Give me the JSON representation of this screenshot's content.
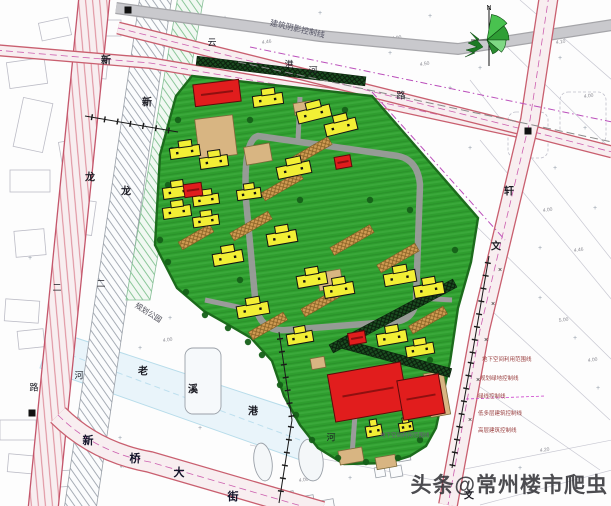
{
  "meta": {
    "watermark": "头条@常州楼市爬虫",
    "plan_type": "residential-site-plan"
  },
  "palette": {
    "site_green": "#2f9e2f",
    "site_green_stripe": "#3aa83a",
    "site_edge": "#1c6b1c",
    "building_yellow": "#f2ef35",
    "building_red": "#e11d1d",
    "paving_tan": "#d8b582",
    "road_pink_fill": "#f8eef0",
    "road_pink_edge": "#c95f6f",
    "road_gray": "#c9c9cd",
    "river_blue": "#e9f4fa",
    "magenta_line": "#bb4fbb",
    "ink": "#1c1c24"
  },
  "map": {
    "site_polygon": "192,76 372,96 478,218 471,262 458,308 450,362 436,428 426,446 410,456 388,463 344,464 318,448 300,425 284,396 272,361 251,338 227,324 204,311 177,288 155,245 160,155 176,96",
    "inner_ring_road": "M258,136 L398,156 Q418,160 420,185 L416,300 Q414,322 390,322 L286,330 Q262,332 256,308 L246,200 Q243,140 258,136 Z",
    "inner_spurs": [
      "M300,97 L298,140",
      "M452,300 L418,298",
      "M352,455 L356,402",
      "M205,300 L252,310"
    ],
    "roads": {
      "left_quad": "79,-4 110,-4 58,510 28,510",
      "left_edges": [
        [
          "79,-4",
          "28,510"
        ],
        [
          "110,-4",
          "58,510"
        ]
      ],
      "bottom_path": "M58,415 Q95,452 150,462 L322,512",
      "east_path": "M549,-5 L530,120 L505,225 L480,330 L448,505",
      "top1_path": "M118,28 L530,131 L612,152",
      "top2_path": "M-5,50 L150,63 L375,101 L528,134",
      "gray_path": "M116,8 L320,36 L458,49 L612,25"
    },
    "river": {
      "poly": "52,330 320,418 306,462 40,368",
      "center": "M70,355 L300,440"
    },
    "hatch_band_gray": "140,-4 172,-4 96,510 64,510",
    "hatch_band_green": "178,-4 204,-4 150,300 126,300",
    "dark_strips": [
      [
        281,
        71,
        170,
        7
      ],
      [
        393,
        316,
        140,
        -28
      ],
      [
        395,
        358,
        115,
        15
      ]
    ],
    "brown_strips": [
      [
        310,
        152,
        46,
        -30
      ],
      [
        282,
        186,
        44,
        -30
      ],
      [
        251,
        226,
        44,
        -30
      ],
      [
        352,
        240,
        46,
        -30
      ],
      [
        398,
        258,
        44,
        -30
      ],
      [
        322,
        302,
        44,
        -30
      ],
      [
        428,
        320,
        40,
        -30
      ],
      [
        268,
        326,
        40,
        -30
      ],
      [
        196,
        237,
        36,
        -30
      ]
    ],
    "tan_patches": [
      [
        216,
        137,
        38,
        40,
        -7
      ],
      [
        258,
        154,
        26,
        18,
        -10
      ],
      [
        303,
        108,
        18,
        12,
        -10
      ],
      [
        330,
        280,
        24,
        18,
        -10
      ],
      [
        318,
        363,
        14,
        11,
        -10
      ],
      [
        437,
        394,
        20,
        44,
        -10
      ],
      [
        351,
        456,
        24,
        14,
        -10
      ],
      [
        386,
        462,
        20,
        12,
        -10
      ]
    ],
    "yellow_buildings": [
      [
        268,
        100,
        30,
        11,
        -8
      ],
      [
        314,
        114,
        34,
        12,
        -14
      ],
      [
        341,
        127,
        32,
        12,
        -14
      ],
      [
        185,
        152,
        30,
        11,
        -8
      ],
      [
        214,
        162,
        28,
        11,
        -8
      ],
      [
        294,
        170,
        34,
        12,
        -12
      ],
      [
        177,
        192,
        28,
        11,
        -8
      ],
      [
        206,
        200,
        26,
        10,
        -8
      ],
      [
        249,
        194,
        24,
        10,
        -8
      ],
      [
        177,
        212,
        28,
        11,
        -8
      ],
      [
        206,
        221,
        26,
        10,
        -8
      ],
      [
        282,
        238,
        30,
        12,
        -10
      ],
      [
        228,
        258,
        30,
        12,
        -10
      ],
      [
        312,
        280,
        30,
        12,
        -10
      ],
      [
        339,
        290,
        30,
        12,
        -10
      ],
      [
        253,
        310,
        32,
        12,
        -10
      ],
      [
        300,
        338,
        26,
        11,
        -10
      ],
      [
        400,
        278,
        32,
        12,
        -10
      ],
      [
        429,
        290,
        30,
        12,
        -10
      ],
      [
        392,
        338,
        30,
        12,
        -10
      ],
      [
        420,
        350,
        28,
        11,
        -10
      ],
      [
        374,
        431,
        16,
        11,
        -10
      ],
      [
        406,
        427,
        14,
        9,
        -10
      ]
    ],
    "red_buildings": [
      [
        217,
        93,
        46,
        22,
        -7
      ],
      [
        193,
        190,
        18,
        13,
        -8
      ],
      [
        343,
        162,
        16,
        12,
        -10
      ],
      [
        357,
        338,
        17,
        12,
        -10
      ],
      [
        368,
        392,
        74,
        48,
        -10
      ],
      [
        421,
        397,
        42,
        40,
        -10
      ]
    ],
    "trees": [
      [
        178,
        120
      ],
      [
        172,
        150
      ],
      [
        168,
        185
      ],
      [
        170,
        215
      ],
      [
        160,
        240
      ],
      [
        168,
        262
      ],
      [
        186,
        292
      ],
      [
        205,
        315
      ],
      [
        228,
        328
      ],
      [
        248,
        342
      ],
      [
        262,
        355
      ],
      [
        280,
        385
      ],
      [
        296,
        415
      ],
      [
        312,
        440
      ],
      [
        338,
        458
      ],
      [
        366,
        462
      ],
      [
        398,
        458
      ],
      [
        420,
        440
      ],
      [
        250,
        120
      ],
      [
        345,
        110
      ],
      [
        410,
        210
      ],
      [
        455,
        250
      ],
      [
        300,
        200
      ],
      [
        370,
        200
      ],
      [
        240,
        280
      ],
      [
        430,
        360
      ]
    ],
    "parcels_left": [
      [
        8,
        60,
        38,
        26,
        -8
      ],
      [
        18,
        100,
        30,
        50,
        12
      ],
      [
        60,
        140,
        26,
        20,
        -10
      ],
      [
        10,
        170,
        40,
        22,
        0
      ],
      [
        70,
        200,
        24,
        34,
        8
      ],
      [
        15,
        230,
        30,
        26,
        -5
      ],
      [
        85,
        60,
        22,
        18,
        6
      ],
      [
        40,
        20,
        30,
        18,
        -12
      ],
      [
        95,
        20,
        26,
        16,
        0
      ],
      [
        5,
        300,
        34,
        22,
        4
      ],
      [
        18,
        330,
        26,
        18,
        -6
      ],
      [
        0,
        420,
        36,
        20,
        0
      ],
      [
        8,
        455,
        30,
        18,
        5
      ],
      [
        60,
        470,
        26,
        16,
        -4
      ]
    ],
    "right_lines": [
      [
        520,
        0,
        612,
        80
      ],
      [
        500,
        40,
        612,
        150
      ],
      [
        470,
        80,
        612,
        260
      ],
      [
        480,
        140,
        612,
        300
      ],
      [
        470,
        220,
        612,
        360
      ],
      [
        480,
        300,
        610,
        420
      ],
      [
        470,
        380,
        600,
        470
      ],
      [
        460,
        470,
        612,
        440
      ],
      [
        480,
        505,
        612,
        470
      ],
      [
        250,
        445,
        460,
        485
      ]
    ],
    "right_outline_rects": [
      [
        560,
        92,
        46,
        52
      ],
      [
        508,
        112,
        40,
        46
      ]
    ],
    "row_houses": [
      [
        383,
        452,
        12,
        11
      ],
      [
        398,
        450,
        12,
        11
      ],
      [
        390,
        466,
        12,
        11
      ],
      [
        375,
        467,
        10,
        10
      ],
      [
        258,
        488,
        16,
        10
      ],
      [
        278,
        492,
        16,
        10
      ],
      [
        298,
        496,
        16,
        10
      ],
      [
        318,
        500,
        16,
        10
      ]
    ],
    "pond_ellipses": [
      [
        263,
        462,
        9,
        19
      ],
      [
        311,
        460,
        12,
        21
      ]
    ],
    "river_parcel": [
      185,
      348,
      36,
      66
    ],
    "dash_magenta": [
      "M250,47 L612,122",
      "M372,92 L505,240"
    ],
    "dash_gray": [
      "M238,62 L612,142"
    ],
    "tick_lines": [
      [
        [
          85,
          116
        ],
        [
          178,
          132
        ]
      ],
      [
        [
          489,
          256
        ],
        [
          472,
          356
        ],
        [
          452,
          468
        ]
      ],
      [
        [
          279,
          332
        ],
        [
          292,
          420
        ],
        [
          279,
          503
        ]
      ]
    ],
    "road_crosses": [
      [
        500,
        272
      ],
      [
        493,
        306
      ],
      [
        486,
        342
      ],
      [
        478,
        382
      ],
      [
        470,
        422
      ]
    ],
    "black_squares": [
      [
        528,
        131
      ],
      [
        32,
        413
      ],
      [
        128,
        10
      ]
    ],
    "plus_marks": [
      [
        225,
        20
      ],
      [
        320,
        15
      ],
      [
        430,
        18
      ],
      [
        390,
        55
      ],
      [
        450,
        90
      ],
      [
        480,
        70
      ],
      [
        560,
        60
      ],
      [
        585,
        130
      ],
      [
        555,
        170
      ],
      [
        595,
        210
      ],
      [
        540,
        300
      ],
      [
        575,
        340
      ],
      [
        598,
        390
      ],
      [
        520,
        470
      ],
      [
        170,
        320
      ],
      [
        140,
        350
      ],
      [
        60,
        310
      ],
      [
        30,
        260
      ],
      [
        120,
        440
      ],
      [
        200,
        430
      ],
      [
        90,
        480
      ],
      [
        350,
        480
      ],
      [
        540,
        250
      ],
      [
        470,
        150
      ]
    ],
    "spot_numbers": [
      [
        "4.00",
        228,
        30
      ],
      [
        "4.46",
        262,
        44
      ],
      [
        "4.00",
        392,
        40
      ],
      [
        "4.50",
        420,
        66
      ],
      [
        "4.10",
        556,
        44
      ],
      [
        "4.00",
        584,
        98
      ],
      [
        "4.00",
        543,
        212
      ],
      [
        "4.46",
        574,
        252
      ],
      [
        "5.00",
        559,
        322
      ],
      [
        "4.00",
        588,
        362
      ],
      [
        "4.20",
        540,
        452
      ],
      [
        "4.00",
        299,
        482
      ],
      [
        "4.36",
        120,
        468
      ],
      [
        "4.00",
        163,
        342
      ],
      [
        "5.00",
        342,
        266
      ],
      [
        "4.00",
        520,
        150
      ]
    ],
    "labels": [
      [
        "新",
        106,
        57,
        10,
        0,
        "#1c1c24"
      ],
      [
        "龙",
        90,
        174,
        10,
        0,
        "#1c1c24"
      ],
      [
        "新",
        147,
        99,
        10,
        0,
        "#1c1c24"
      ],
      [
        "龙",
        126,
        188,
        10,
        0,
        "#1c1c24"
      ],
      [
        "云",
        212,
        39,
        9,
        0,
        "#1c1c24"
      ],
      [
        "港",
        289,
        61,
        9,
        0,
        "#1c1c24"
      ],
      [
        "河",
        313,
        67,
        9,
        0,
        "#1c1c24"
      ],
      [
        "路",
        401,
        92,
        9,
        0,
        "#1c1c24"
      ],
      [
        "轩",
        509,
        188,
        10,
        0,
        "#1c1c24"
      ],
      [
        "文",
        496,
        243,
        10,
        0,
        "#1c1c24"
      ],
      [
        "文",
        469,
        492,
        10,
        0,
        "#1c1c24"
      ],
      [
        "二",
        57,
        284,
        9,
        0,
        "#1c1c24"
      ],
      [
        "二",
        101,
        280,
        9,
        0,
        "#1c1c24"
      ],
      [
        "河",
        79,
        372,
        9,
        0,
        "#1c1c24"
      ],
      [
        "路",
        34,
        384,
        9,
        0,
        "#1c1c24"
      ],
      [
        "老",
        143,
        368,
        10,
        0,
        "#1c1c24"
      ],
      [
        "溪",
        193,
        386,
        10,
        0,
        "#1c1c24"
      ],
      [
        "港",
        253,
        408,
        10,
        0,
        "#1c1c24"
      ],
      [
        "河",
        331,
        434,
        9,
        0,
        "#1c1c24"
      ],
      [
        "新",
        88,
        437,
        11,
        0,
        "#14142a"
      ],
      [
        "桥",
        135,
        455,
        11,
        0,
        "#14142a"
      ],
      [
        "大",
        179,
        469,
        11,
        0,
        "#14142a"
      ],
      [
        "街",
        233,
        493,
        11,
        0,
        "#14142a"
      ],
      [
        "规划公园",
        150,
        310,
        7.5,
        32,
        "#4a4a55"
      ],
      [
        "建筑阴影控制线",
        298,
        26,
        8,
        13,
        "#555566"
      ],
      [
        "N",
        489,
        6,
        7,
        0,
        "#111111"
      ],
      [
        "地下空间利用范围线",
        482,
        358,
        5.5,
        0,
        "#9a4040"
      ],
      [
        "规划绿地控制线",
        480,
        377,
        5.5,
        0,
        "#9a4040"
      ],
      [
        "绿线控制线",
        478,
        395,
        5.5,
        0,
        "#9a4040"
      ],
      [
        "低多层建筑控制线",
        478,
        412,
        5.5,
        0,
        "#9a4040"
      ],
      [
        "高层建筑控制线",
        478,
        429,
        5.5,
        0,
        "#9a4040"
      ],
      [
        "地下空间利用范围线",
        380,
        434,
        5.5,
        0,
        "#6b5a7a"
      ]
    ]
  }
}
